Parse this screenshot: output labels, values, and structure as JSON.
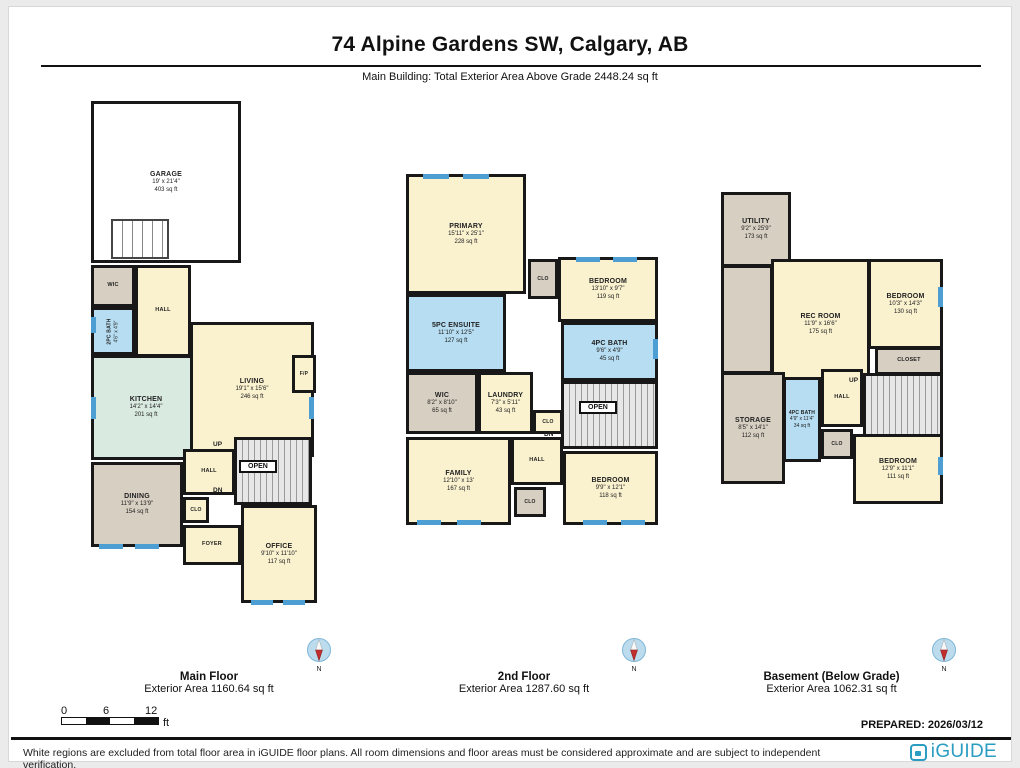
{
  "header": {
    "title": "74 Alpine Gardens SW, Calgary, AB",
    "subtitle": "Main Building: Total Exterior Area Above Grade 2448.24 sq ft"
  },
  "floors": [
    {
      "name": "Main Floor",
      "area_label": "Exterior Area 1160.64 sq ft",
      "rooms": {
        "garage": {
          "name": "GARAGE",
          "dims": "19' x 21'4\"",
          "area": "403 sq ft"
        },
        "wic": {
          "name": "WIC"
        },
        "hall_upper": {
          "name": "HALL"
        },
        "bath": {
          "name": "2PC BATH",
          "dims": "4'6\" x 4'9\""
        },
        "kitchen": {
          "name": "KITCHEN",
          "dims": "14'2\" x 14'4\"",
          "area": "201 sq ft"
        },
        "living": {
          "name": "LIVING",
          "dims": "19'1\" x 15'6\"",
          "area": "246 sq ft"
        },
        "fireplace": {
          "name": "F/P"
        },
        "dining": {
          "name": "DINING",
          "dims": "11'9\" x 13'9\"",
          "area": "154 sq ft"
        },
        "hall_lower": {
          "name": "HALL"
        },
        "closet": {
          "name": "CLO"
        },
        "foyer": {
          "name": "FOYER"
        },
        "office": {
          "name": "OFFICE",
          "dims": "9'10\" x 11'10\"",
          "area": "117 sq ft"
        },
        "open": {
          "name": "OPEN"
        },
        "up": {
          "name": "UP"
        },
        "dn": {
          "name": "DN"
        }
      }
    },
    {
      "name": "2nd Floor",
      "area_label": "Exterior Area 1287.60 sq ft",
      "rooms": {
        "primary": {
          "name": "PRIMARY",
          "dims": "15'11\" x 25'1\"",
          "area": "228 sq ft"
        },
        "ensuite": {
          "name": "5PC ENSUITE",
          "dims": "11'10\" x 12'5\"",
          "area": "127 sq ft"
        },
        "closet_top": {
          "name": "CLO"
        },
        "bedroom_front": {
          "name": "BEDROOM",
          "dims": "13'10\" x 9'7\"",
          "area": "119 sq ft"
        },
        "bath": {
          "name": "4PC BATH",
          "dims": "9'6\" x 4'9\"",
          "area": "45 sq ft"
        },
        "wic": {
          "name": "WIC",
          "dims": "8'2\" x 8'10\"",
          "area": "65 sq ft"
        },
        "laundry": {
          "name": "LAUNDRY",
          "dims": "7'3\" x 5'11\"",
          "area": "43 sq ft"
        },
        "closet_mid": {
          "name": "CLO"
        },
        "family": {
          "name": "FAMILY",
          "dims": "12'10\" x 13'",
          "area": "167 sq ft"
        },
        "hall": {
          "name": "HALL"
        },
        "closet_lower": {
          "name": "CLO"
        },
        "bedroom_rear": {
          "name": "BEDROOM",
          "dims": "9'9\" x 12'1\"",
          "area": "118 sq ft"
        },
        "open": {
          "name": "OPEN"
        },
        "dn": {
          "name": "DN"
        }
      }
    },
    {
      "name": "Basement (Below Grade)",
      "area_label": "Exterior Area 1062.31 sq ft",
      "rooms": {
        "utility": {
          "name": "UTILITY",
          "dims": "9'2\" x 25'9\"",
          "area": "173 sq ft"
        },
        "rec_room": {
          "name": "REC ROOM",
          "dims": "11'9\" x 16'6\"",
          "area": "175 sq ft"
        },
        "bedroom_upper": {
          "name": "BEDROOM",
          "dims": "10'3\" x 14'3\"",
          "area": "130 sq ft"
        },
        "closet_big": {
          "name": "CLOSET"
        },
        "up": {
          "name": "UP"
        },
        "hall": {
          "name": "HALL"
        },
        "bath": {
          "name": "4PC BATH",
          "dims": "4'9\" x 11'4\"",
          "area": "34 sq ft"
        },
        "closet": {
          "name": "CLO"
        },
        "storage": {
          "name": "STORAGE",
          "dims": "8'5\" x 14'1\"",
          "area": "112 sq ft"
        },
        "bedroom_lower": {
          "name": "BEDROOM",
          "dims": "12'9\" x 11'1\"",
          "area": "111 sq ft"
        }
      }
    }
  ],
  "compass": {
    "label": "N"
  },
  "scalebar": {
    "start": "0",
    "mid": "6",
    "end": "12",
    "unit": "ft"
  },
  "prepared": "PREPARED: 2026/03/12",
  "footer": {
    "disclaimer": "White regions are excluded from total floor area in iGUIDE floor plans. All room dimensions and floor areas must be considered approximate and are subject to independent verification.",
    "brand": "iGUIDE"
  },
  "colors": {
    "wall": "#181818",
    "room_cream": "#faf1cf",
    "bath_blue": "#b6ddf1",
    "closet_tan": "#d8cfc3",
    "kitchen_teal": "#d9eae1",
    "window_blue": "#4d9ed2",
    "brand_teal": "#2b9dc2"
  }
}
